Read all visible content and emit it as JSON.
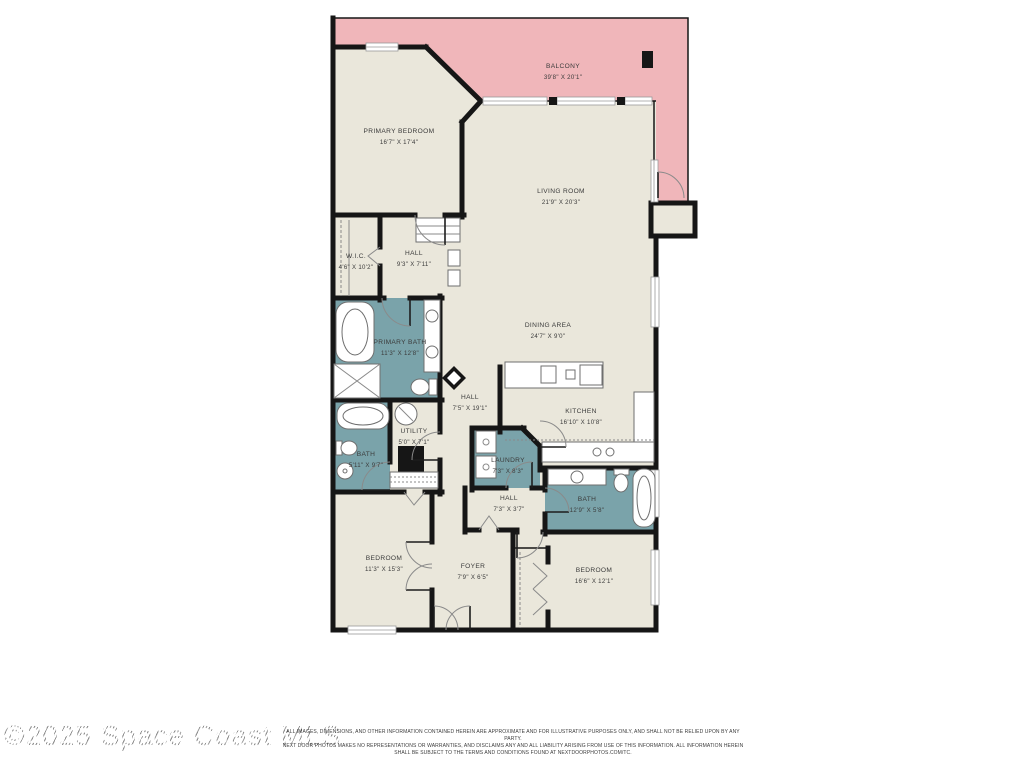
{
  "watermark": "©2025 Space Coast MLS",
  "disclaimer": {
    "line1": "ALL IMAGES, DIMENSIONS, AND OTHER INFORMATION CONTAINED HEREIN ARE APPROXIMATE AND FOR ILLUSTRATIVE PURPOSES ONLY, AND SHALL NOT BE RELIED UPON BY ANY PARTY.",
    "line2": "NEXT DOOR PHOTOS MAKES NO REPRESENTATIONS OR WARRANTIES, AND DISCLAIMS ANY AND ALL LIABILITY ARISING FROM USE OF THIS INFORMATION. ALL INFORMATION HEREIN",
    "line3": "SHALL BE SUBJECT TO THE TERMS AND CONDITIONS FOUND AT NEXTDOORPHOTOS.COM/TC."
  },
  "colors": {
    "balcony": "#f0b6ba",
    "room": "#eae7db",
    "wet_room": "#7aa3aa",
    "wall": "#161616",
    "label": "#3b3b3b"
  },
  "rooms": {
    "balcony": {
      "name": "BALCONY",
      "dims": "39'8\" X 20'1\""
    },
    "primary_bedroom": {
      "name": "PRIMARY BEDROOM",
      "dims": "16'7\" X 17'4\""
    },
    "living_room": {
      "name": "LIVING ROOM",
      "dims": "21'9\" X 20'3\""
    },
    "wic": {
      "name": "W.I.C.",
      "dims": "4'6\" X 10'2\""
    },
    "hall_upper": {
      "name": "HALL",
      "dims": "9'3\" X 7'11\""
    },
    "primary_bath": {
      "name": "PRIMARY BATH",
      "dims": "11'3\" X 12'8\""
    },
    "dining_area": {
      "name": "DINING AREA",
      "dims": "24'7\" X 9'0\""
    },
    "hall_center": {
      "name": "HALL",
      "dims": "7'5\" X 19'1\""
    },
    "utility": {
      "name": "UTILITY",
      "dims": "5'0\" X 7'1\""
    },
    "kitchen": {
      "name": "KITCHEN",
      "dims": "16'10\" X 10'8\""
    },
    "bath_left": {
      "name": "BATH",
      "dims": "5'11\" X 9'7\""
    },
    "laundry": {
      "name": "LAUNDRY",
      "dims": "7'3\" X 8'3\""
    },
    "hall_lower": {
      "name": "HALL",
      "dims": "7'3\" X 3'7\""
    },
    "bath_right": {
      "name": "BATH",
      "dims": "12'9\" X 5'8\""
    },
    "bedroom_left": {
      "name": "BEDROOM",
      "dims": "11'3\" X 15'3\""
    },
    "foyer": {
      "name": "FOYER",
      "dims": "7'9\" X 6'5\""
    },
    "bedroom_right": {
      "name": "BEDROOM",
      "dims": "16'6\" X 12'1\""
    }
  }
}
